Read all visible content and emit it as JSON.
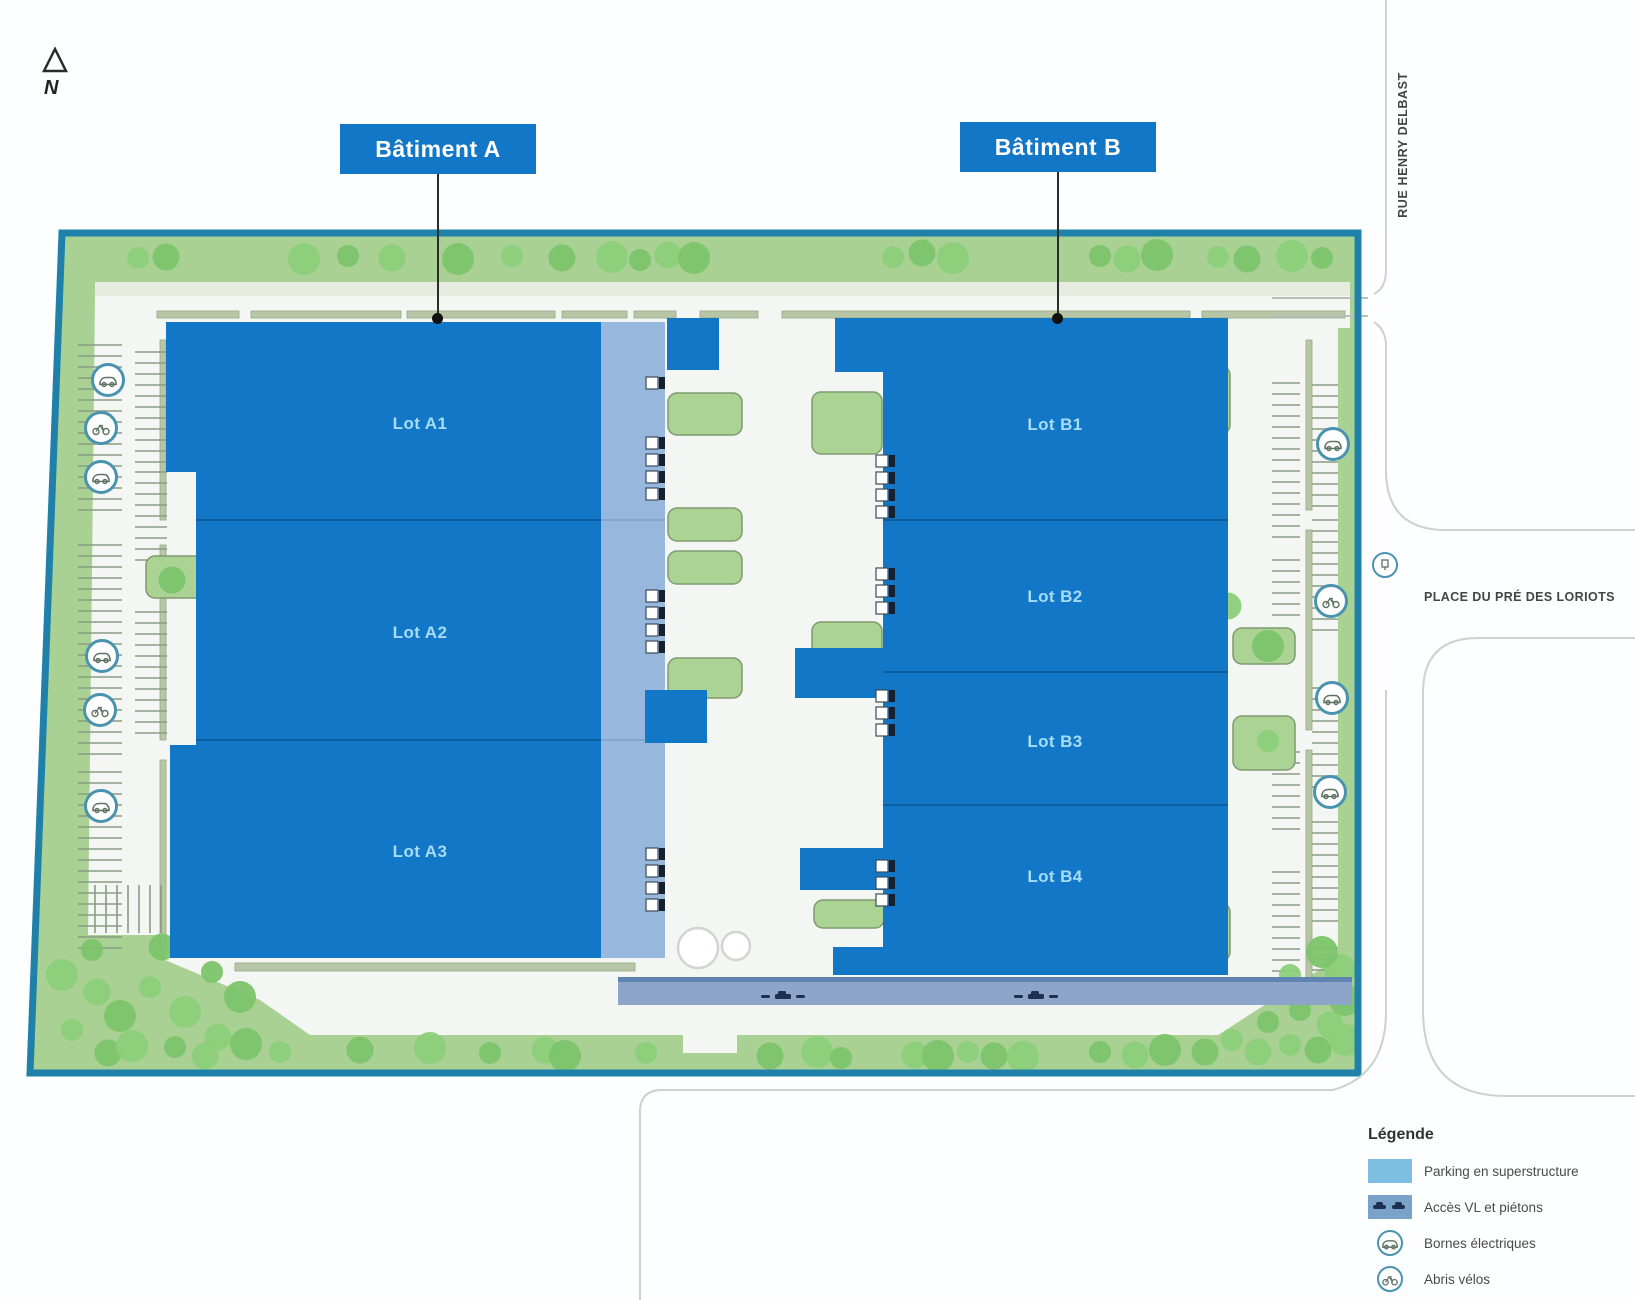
{
  "north_label": "N",
  "buildings": {
    "a": {
      "label": "Bâtiment A",
      "lots": [
        {
          "label": "Lot A1"
        },
        {
          "label": "Lot A2"
        },
        {
          "label": "Lot A3"
        }
      ]
    },
    "b": {
      "label": "Bâtiment B",
      "lots": [
        {
          "label": "Lot B1"
        },
        {
          "label": "Lot B2"
        },
        {
          "label": "Lot B3"
        },
        {
          "label": "Lot B4"
        }
      ]
    }
  },
  "streets": {
    "rue": "RUE HENRY DELBAST",
    "place": "PLACE DU PRÉ DES LORIOTS"
  },
  "legend": {
    "title": "Légende",
    "items": [
      {
        "label": "Parking en superstructure",
        "symbol": "parking-swatch"
      },
      {
        "label": "Accès VL et piétons",
        "symbol": "access-swatch"
      },
      {
        "label": "Bornes électriques",
        "symbol": "ev-charger-icon"
      },
      {
        "label": "Abris vélos",
        "symbol": "bike-shelter-icon"
      }
    ]
  },
  "colors": {
    "site_border": "#1f81aa",
    "site_green": "#a9d193",
    "inner_white": "#f3f6f2",
    "building_blue": "#1377c8",
    "parking_strip": "#98b7dc",
    "access_road": "#8ca5c9",
    "legend_parking": "#7cbfe3",
    "tree_green": "#7cc46c",
    "lot_text": "#a6dcf6"
  }
}
